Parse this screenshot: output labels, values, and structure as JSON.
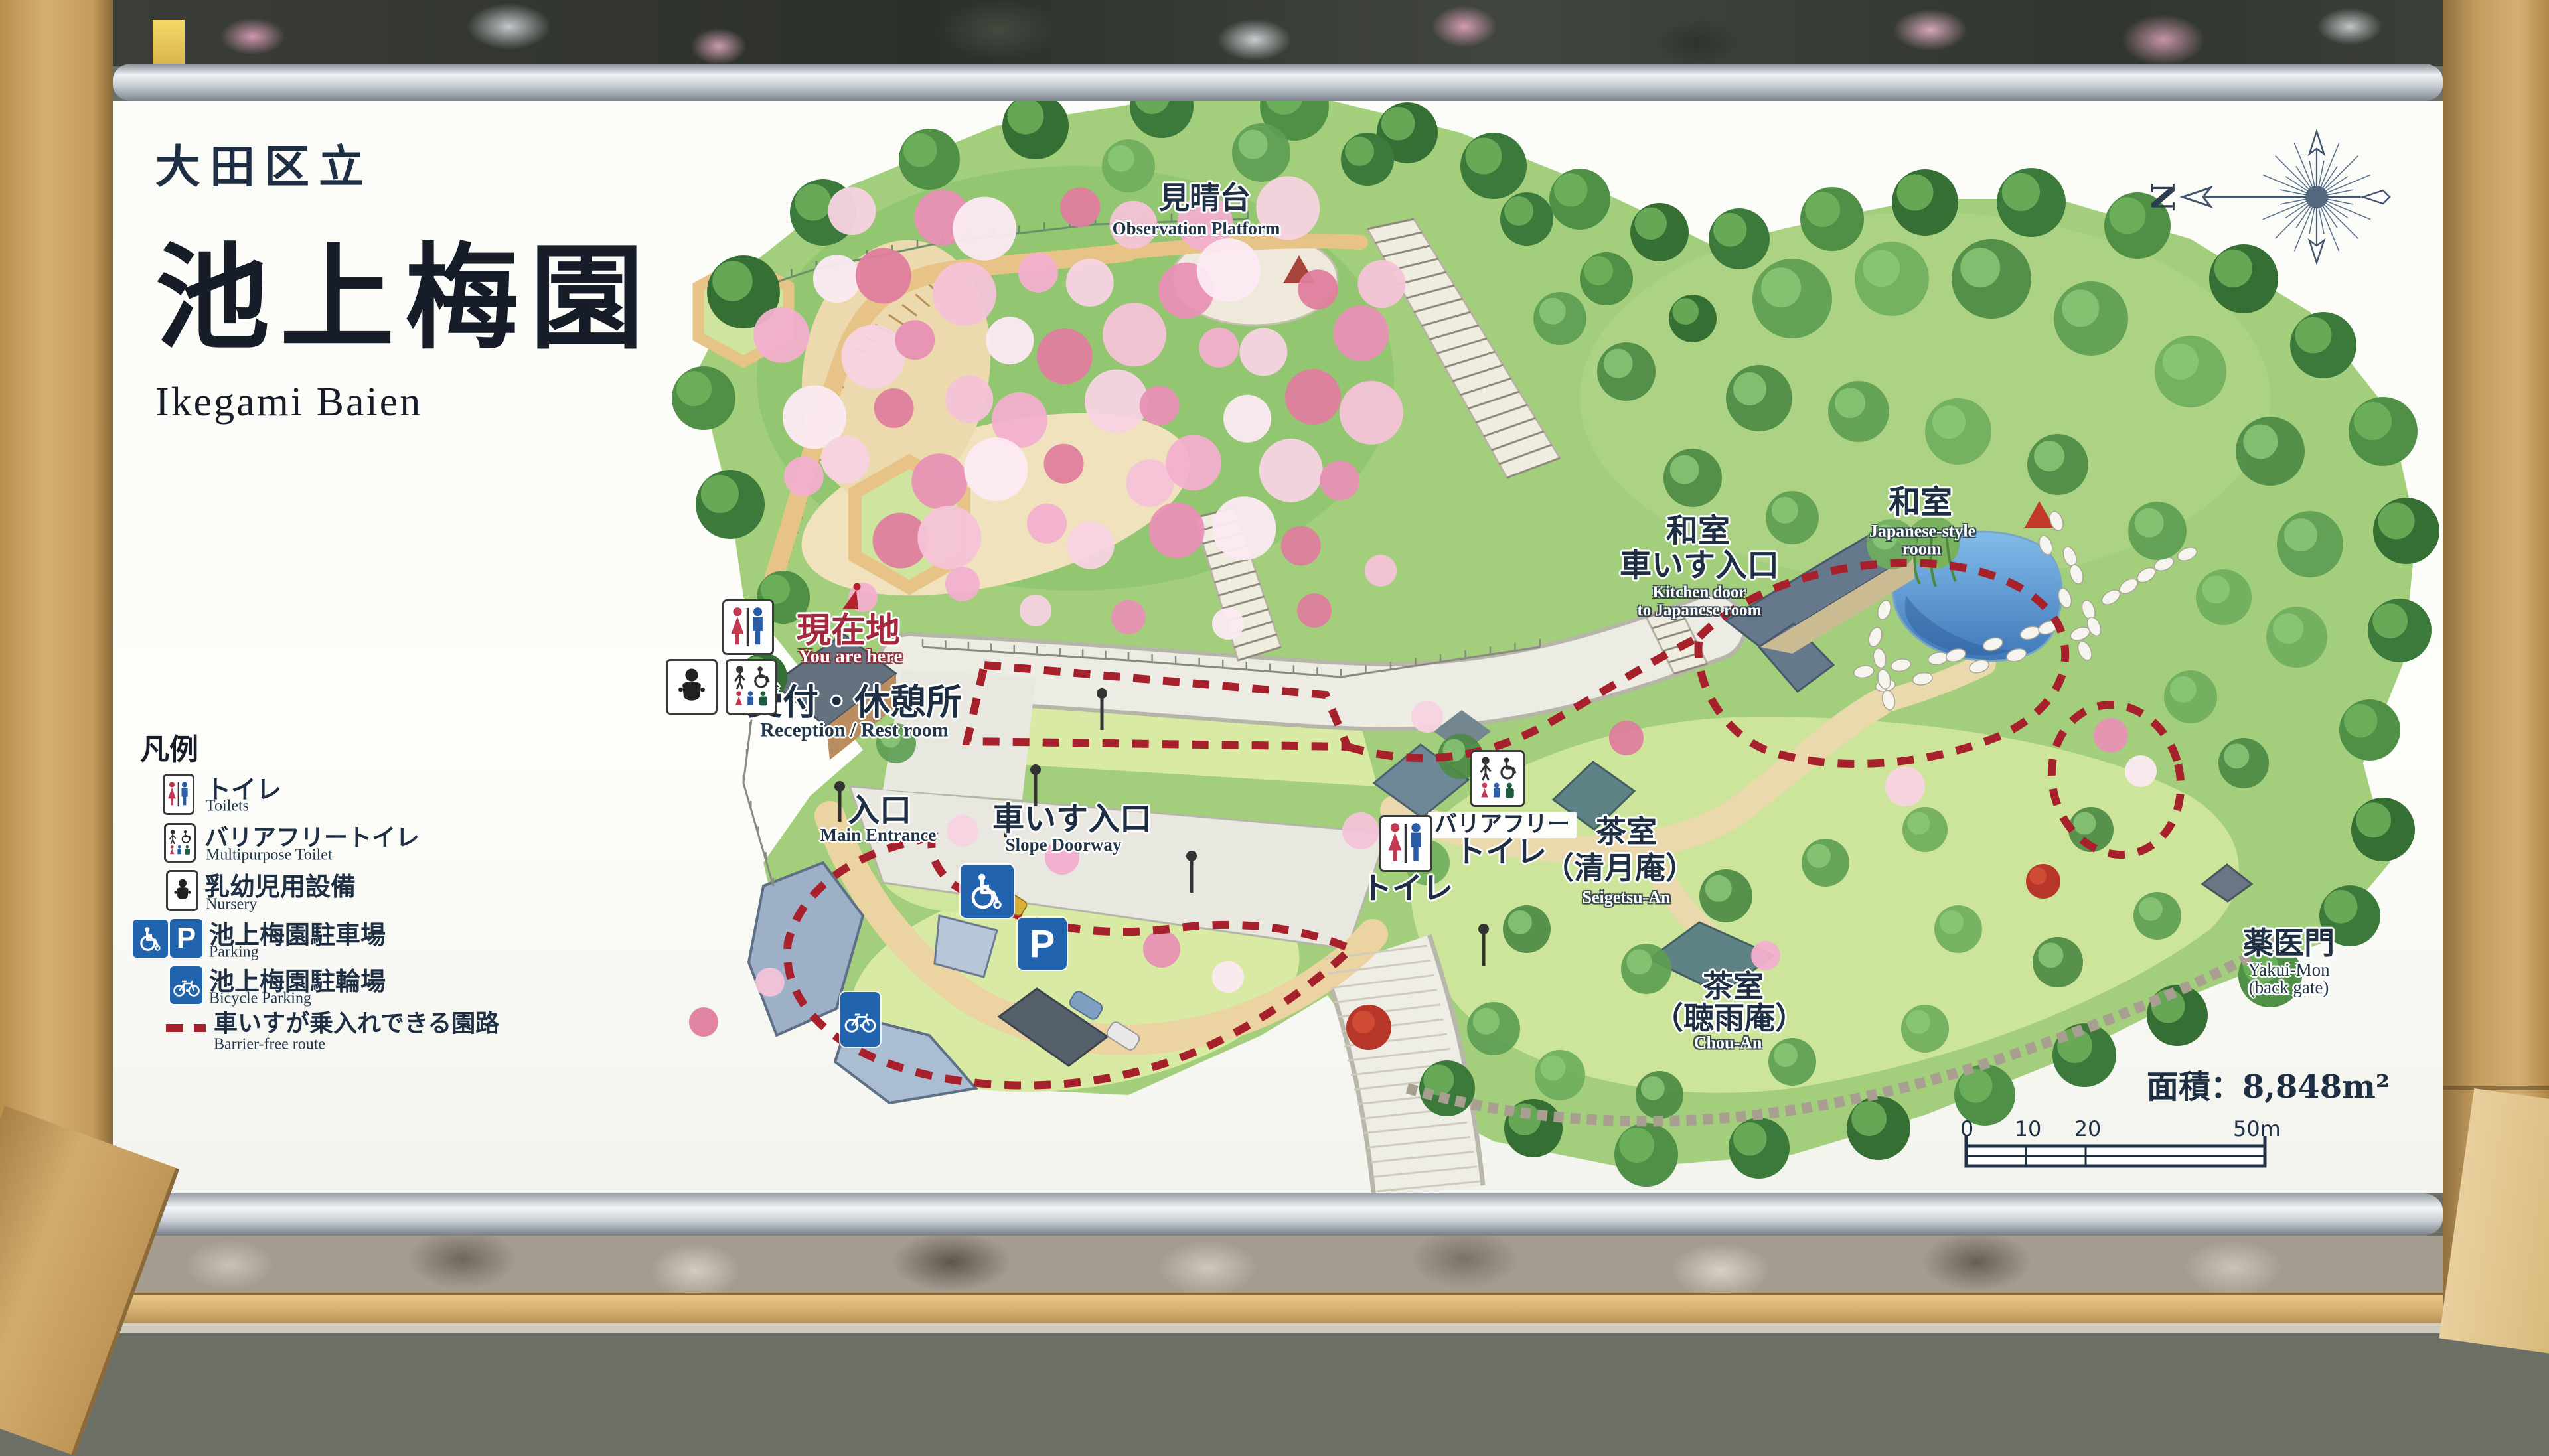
{
  "sign": {
    "org": "大田区立",
    "title": "池上梅園",
    "title_en": "Ikegami Baien",
    "area": "面積：8,848m²"
  },
  "compass": {
    "north": "N"
  },
  "legend": {
    "heading": "凡例",
    "items": [
      {
        "jp": "トイレ",
        "en": "Toilets"
      },
      {
        "jp": "バリアフリートイレ",
        "en": "Multipurpose Toilet"
      },
      {
        "jp": "乳幼児用設備",
        "en": "Nursery"
      },
      {
        "jp": "池上梅園駐車場",
        "en": "Parking"
      },
      {
        "jp": "池上梅園駐輪場",
        "en": "Bicycle Parking"
      },
      {
        "jp": "車いすが乗入れできる園路",
        "en": "Barrier-free route"
      }
    ]
  },
  "labels": {
    "observation": {
      "jp": "見晴台",
      "en": "Observation Platform"
    },
    "washitsu_kitchen": {
      "jp1": "和室",
      "jp2": "車いす入口",
      "en1": "Kitchen door",
      "en2": "to Japanese room"
    },
    "washitsu": {
      "jp": "和室",
      "en1": "Japanese-style",
      "en2": "room"
    },
    "here": {
      "jp": "現在地",
      "en": "You are here"
    },
    "reception": {
      "jp": "受付・休憩所",
      "en": "Reception / Rest room"
    },
    "entrance": {
      "jp": "入口",
      "en": "Main Entrance"
    },
    "slope": {
      "jp": "車いす入口",
      "en": "Slope Doorway"
    },
    "toilet": {
      "jp": "トイレ"
    },
    "barrier_free": {
      "jp1": "バリアフリー",
      "jp2": "トイレ"
    },
    "seigetsu": {
      "jp1": "茶室",
      "jp2": "（清月庵）",
      "en": "Seigetsu-An"
    },
    "chouan": {
      "jp1": "茶室",
      "jp2": "（聴雨庵）",
      "en": "Chou-An"
    },
    "yakuimon": {
      "jp": "薬医門",
      "en1": "Yakui-Mon",
      "en2": "(back gate)"
    }
  },
  "icons": {
    "parking_letter": "P"
  },
  "scale": {
    "t0": "0",
    "t10": "10",
    "t20": "20",
    "t50": "50m"
  }
}
